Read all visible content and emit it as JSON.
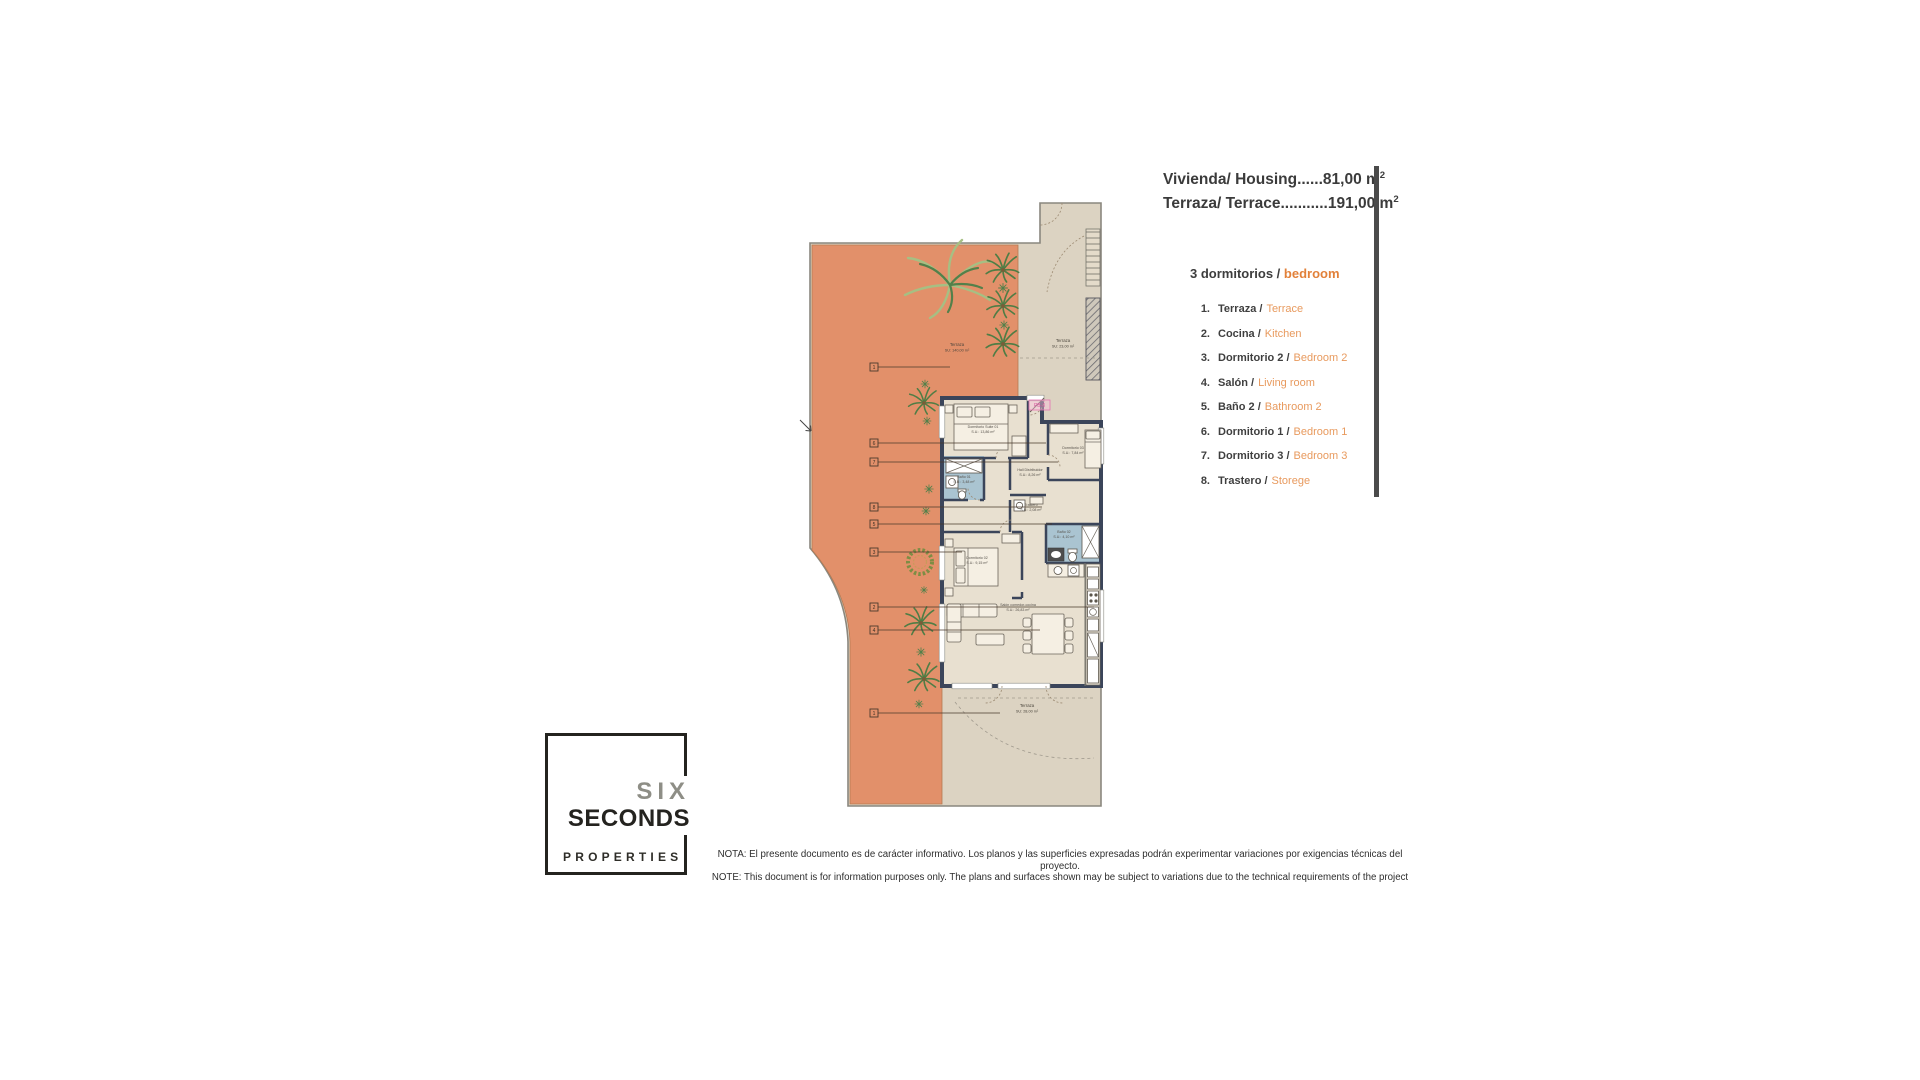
{
  "header": {
    "housing": "Vivienda/ Housing......81,00 m",
    "terrace": "Terraza/ Terrace...........191,00 m",
    "sup": "2"
  },
  "legend": {
    "title_es": "3 dormitorios /",
    "title_en": "bedroom",
    "items": [
      {
        "num": "1.",
        "es": "Terraza /",
        "en": "Terrace"
      },
      {
        "num": "2.",
        "es": "Cocina /",
        "en": "Kitchen"
      },
      {
        "num": "3.",
        "es": "Dormitorio 2 /",
        "en": "Bedroom 2"
      },
      {
        "num": "4.",
        "es": "Salón /",
        "en": "Living room"
      },
      {
        "num": "5.",
        "es": "Baño 2 /",
        "en": "Bathroom 2"
      },
      {
        "num": "6.",
        "es": "Dormitorio 1 /",
        "en": "Bedroom 1"
      },
      {
        "num": "7.",
        "es": "Dormitorio 3 /",
        "en": "Bedroom 3"
      },
      {
        "num": "8.",
        "es": "Trastero /",
        "en": "Storege"
      }
    ]
  },
  "plan": {
    "unit_tag": "PB-3",
    "markers": [
      "1",
      "6",
      "7",
      "8",
      "5",
      "3",
      "2",
      "4",
      "1"
    ],
    "terraces": {
      "top": {
        "name": "Terraza",
        "area": "SU: 140,00 m²"
      },
      "right": {
        "name": "Terraza",
        "area": "SU: 23,00 m²"
      },
      "bottom": {
        "name": "Terraza",
        "area": "SU: 28,00 m²"
      }
    },
    "rooms": {
      "suite": {
        "name": "Dormitorio Suite 01",
        "area": "S.U.: 13,86 m²"
      },
      "bedroom3": {
        "name": "Dormitorio 03",
        "area": "S.U.: 7,84 m²"
      },
      "hall": {
        "name": "Hall Distribuidor",
        "area": "S.U.: 8,26 m²"
      },
      "bath1": {
        "name": "Baño 01",
        "area": "S.U.: 3,48 m²"
      },
      "storage": {
        "name": "Trastero",
        "area": "S.U.: 2,08 m²"
      },
      "bath2": {
        "name": "Baño 02",
        "area": "S.U.: 4,10 m²"
      },
      "bedroom2": {
        "name": "Dormitorio 02",
        "area": "S.U.: 9,15 m²"
      },
      "living": {
        "name": "Salón comedor-cocina",
        "area": "S.U.: 26,83 m²"
      }
    }
  },
  "logo": {
    "six": "SIX",
    "seconds": "SECONDS",
    "properties": "PROPERTIES"
  },
  "note": {
    "es": "NOTA: El presente documento es de carácter informativo. Los planos y las superficies expresadas podrán experimentar variaciones por exigencias técnicas del proyecto.",
    "en": "NOTE: This document is for information purposes only. The plans and surfaces shown may be subject to variations due to the technical requirements of the project"
  },
  "colors": {
    "terrace_orange": "#e2906a",
    "terrace_beige": "#dcd3c2",
    "interior_floor": "#e8e0d0",
    "wall": "#3b455a",
    "bath_blue": "#aac4d1",
    "accent_orange": "#e89a5e"
  }
}
